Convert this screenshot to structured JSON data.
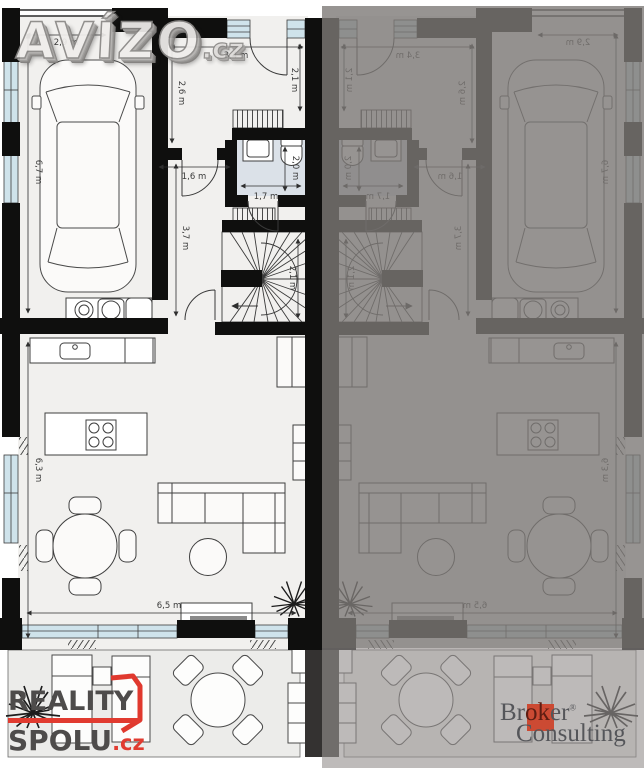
{
  "watermarks": {
    "avizo_text": "AVÍZO",
    "avizo_tld": ".cz",
    "reality_line1": "REALITY",
    "reality_line2": "SPOLU",
    "reality_tld": ".cz",
    "broker_part1": "Br",
    "broker_part2": "ok",
    "broker_part3": "er",
    "broker_reg": "®",
    "broker_line2": "Consulting"
  },
  "dims": {
    "garage_width": "2,9 m",
    "hall_width": "3,4 m",
    "entry_depth_left": "2,6 m",
    "entry_depth_right": "2,1 m",
    "garage_length": "6,7 m",
    "hall_door": "1,6 m",
    "corridor_length": "3,7 m",
    "wc_depth": "2,0 m",
    "wc_width": "1,7 m",
    "stairs_depth": "2,1 m",
    "living_depth": "6,3 m",
    "living_width": "6,5 m"
  },
  "colors": {
    "wall": "#0f0f0e",
    "window": "#cfe3eb",
    "floor": "#f1f0ee",
    "bath_floor": "#dbe1e8",
    "terrace": "#ececea",
    "overlay_dark": "#7d7977",
    "overlay_light": "#969290",
    "accent_red": "#e0392e",
    "broker_red": "#cc4a33"
  }
}
